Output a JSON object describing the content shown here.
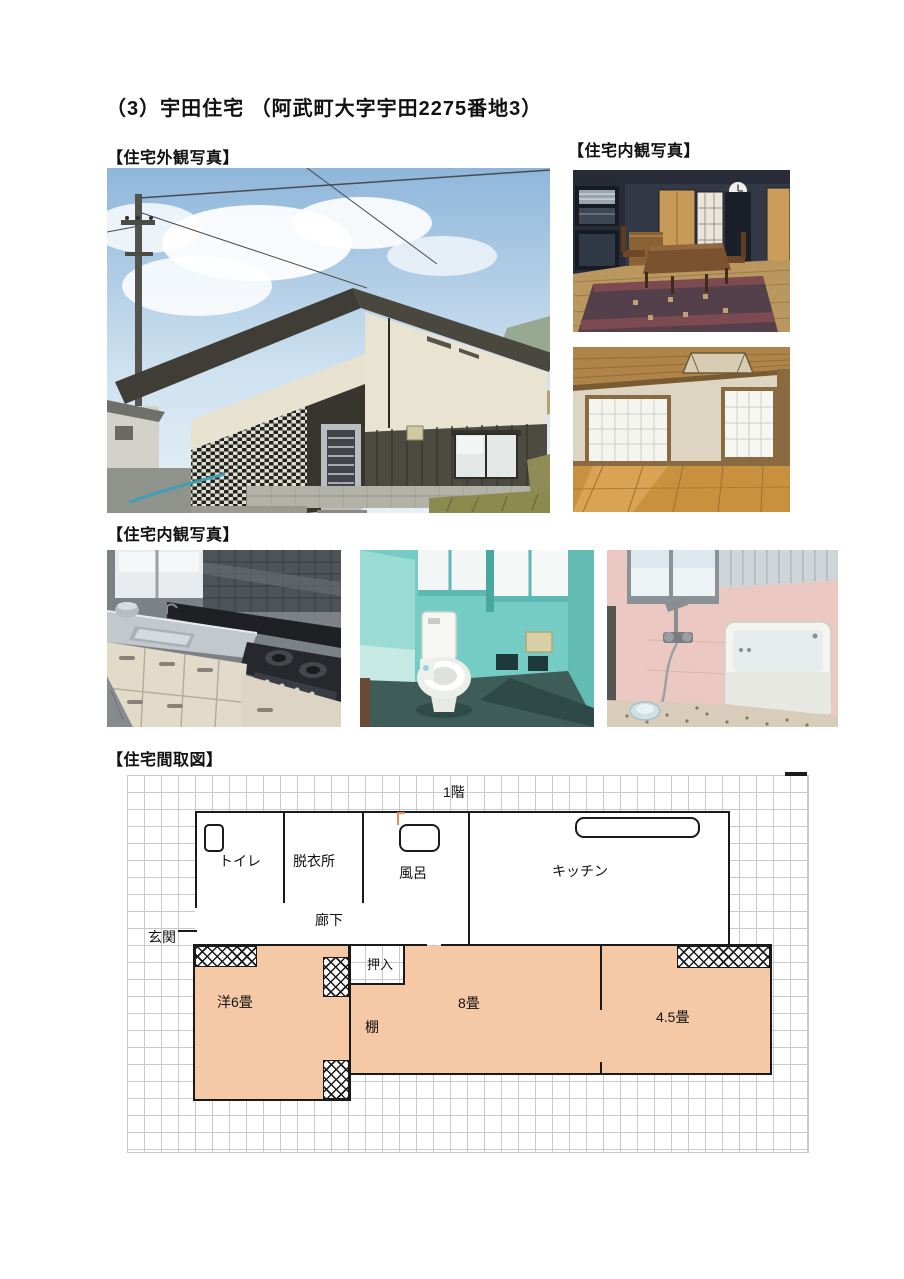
{
  "page": {
    "title": "（3）宇田住宅 （阿武町大字宇田2275番地3）"
  },
  "headings": {
    "exterior": "【住宅外観写真】",
    "interior_right": "【住宅内観写真】",
    "interior_bottom": "【住宅内観写真】",
    "floorplan": "【住宅間取図】"
  },
  "floorplan": {
    "floor_label": "1階",
    "rooms": {
      "toilet": "トイレ",
      "dressing_room": "脱衣所",
      "bath": "風呂",
      "kitchen": "キッチン",
      "hallway": "廊下",
      "entrance": "玄関",
      "closet": "押入",
      "western_6tatami": "洋6畳",
      "tatami_8": "8畳",
      "tatami_4_5": "4.5畳",
      "shelf": "棚"
    },
    "colors": {
      "tatami_room_fill": "#F5C8A6",
      "wall": "#1a1a1a",
      "grid_line": "#c9c9c9"
    }
  }
}
